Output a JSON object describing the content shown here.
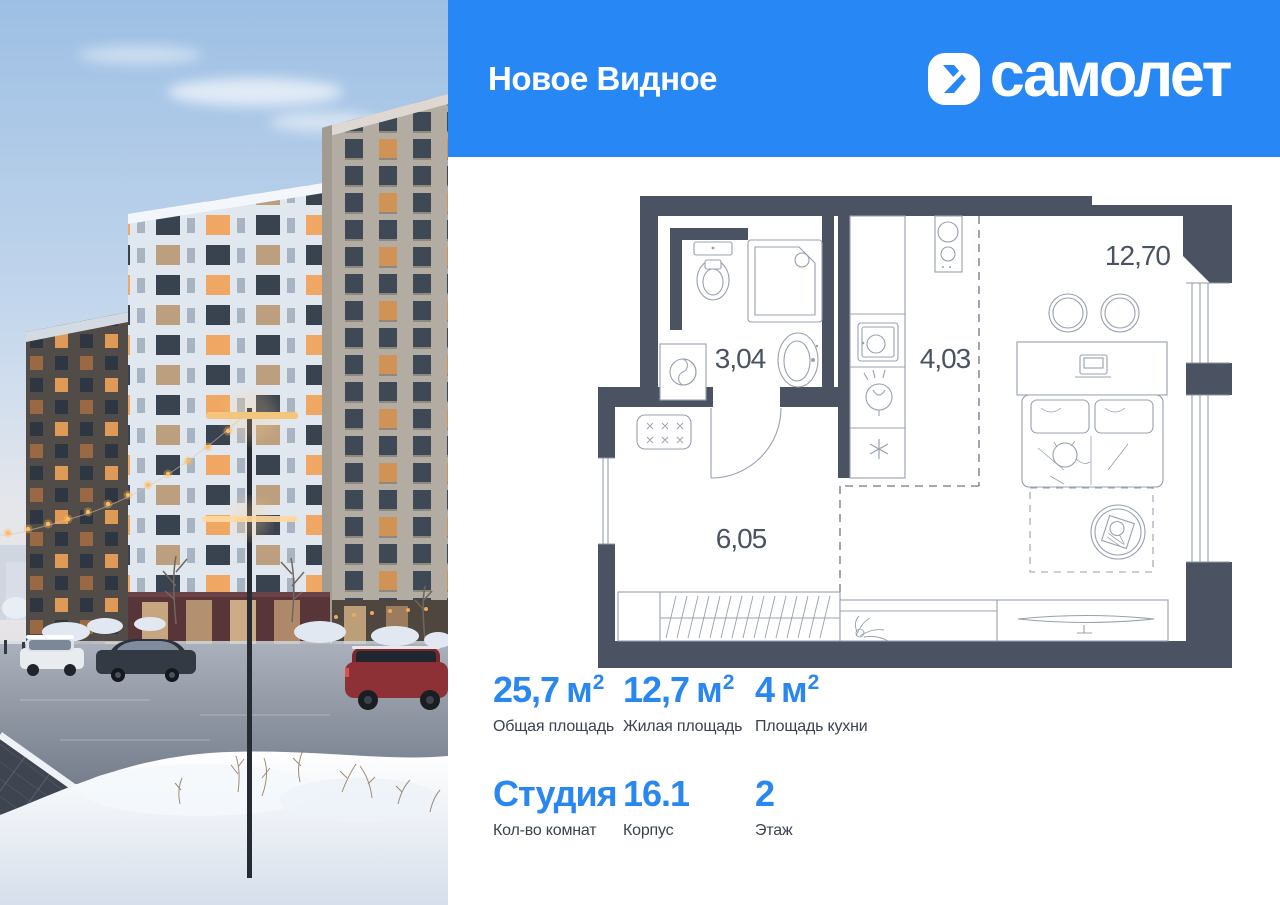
{
  "header": {
    "project_title": "Новое Видное",
    "brand_name": "самолет"
  },
  "colors": {
    "brand_blue": "#2787f5",
    "stat_value_blue": "#2b87f0",
    "wall_dark": "#4b5363",
    "label_dark": "#3b4350"
  },
  "plan": {
    "rooms": [
      {
        "id": "bathroom",
        "area": "3,04"
      },
      {
        "id": "kitchen",
        "area": "4,03"
      },
      {
        "id": "hallway",
        "area": "6,05"
      },
      {
        "id": "living-room",
        "area": "12,70"
      }
    ]
  },
  "stats": {
    "items": [
      {
        "value": "25,7",
        "unit": "м",
        "sup": "2",
        "label": "Общая площадь"
      },
      {
        "value": "12,7",
        "unit": "м",
        "sup": "2",
        "label": "Жилая площадь"
      },
      {
        "value": "4",
        "unit": "м",
        "sup": "2",
        "label": "Площадь кухни"
      },
      {
        "value": "Студия",
        "unit": "",
        "sup": "",
        "label": "Кол-во комнат"
      },
      {
        "value": "16.1",
        "unit": "",
        "sup": "",
        "label": "Корпус"
      },
      {
        "value": "2",
        "unit": "",
        "sup": "",
        "label": "Этаж"
      }
    ]
  }
}
